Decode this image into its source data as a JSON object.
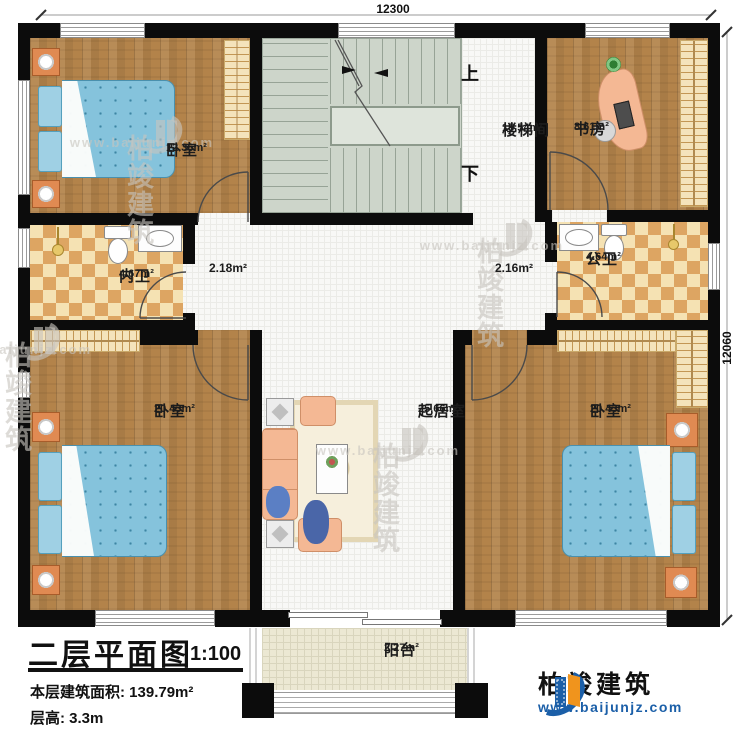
{
  "dimensions": {
    "top": "12300",
    "right": "12060"
  },
  "stairs": {
    "up": "上",
    "down": "下"
  },
  "rooms": {
    "bedroom_tl": {
      "name": "卧室",
      "area": "12.36m²"
    },
    "stairwell": {
      "name": "楼梯间",
      "area": "15.54m²"
    },
    "study": {
      "name": "书房",
      "area": "8.61m²"
    },
    "inner_bath": {
      "name": "内卫",
      "area": "4.67m²"
    },
    "hall_left": {
      "area": "2.18m²"
    },
    "hall_right": {
      "area": "2.16m²"
    },
    "public_bath": {
      "name": "公卫",
      "area": "4.64m²"
    },
    "bedroom_bl": {
      "name": "卧室",
      "area": "20.43m²"
    },
    "living": {
      "name": "起居室",
      "area": "25.66m²"
    },
    "bedroom_br": {
      "name": "卧室",
      "area": "20.43m²"
    },
    "balcony": {
      "name": "阳台",
      "area": "2.27m²"
    }
  },
  "title_block": {
    "title": "二层平面图",
    "scale": "1:100",
    "floor_area_label": "本层建筑面积: 139.79m²",
    "floor_height_label": "层高: 3.3m"
  },
  "brand": {
    "name": "柏竣建筑",
    "url": "www.baijunjz.com"
  },
  "watermark": {
    "name": "柏竣建筑",
    "url": "www.baijunjz.com"
  },
  "colors": {
    "wall": "#0c0c0c",
    "wood_floor": "#b3834a",
    "tile_light": "#f5e2b3",
    "tile_dark": "#dda562",
    "stair": "#cdd5ca",
    "bed_blue": "#85c3dc",
    "furniture_salmon": "#f4b894",
    "nightstand_orange": "#e08a52",
    "balcony_tile": "#ece8d3",
    "brand_blue": "#1b5fa8",
    "brand_orange": "#f0941d"
  }
}
